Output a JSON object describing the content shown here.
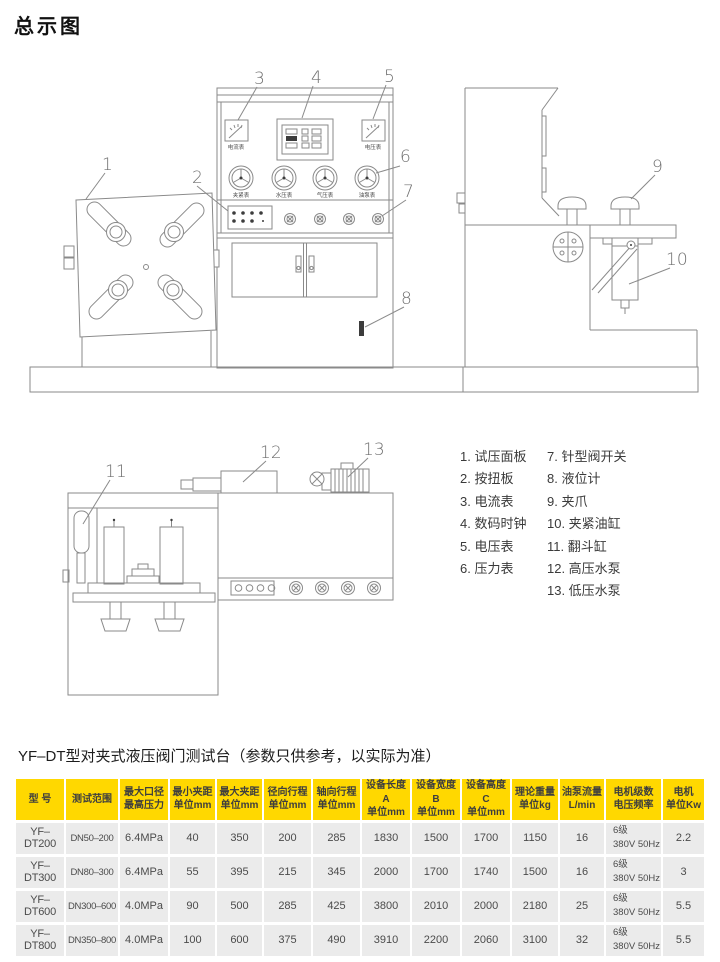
{
  "page": {
    "title": "总示图"
  },
  "diagram": {
    "callouts": [
      "1",
      "2",
      "3",
      "4",
      "5",
      "6",
      "7",
      "8",
      "9",
      "10",
      "11",
      "12",
      "13"
    ],
    "front": {
      "ammeter_label": "电流表",
      "voltmeter_label": "电压表",
      "gauges": [
        "夹紧表",
        "水压表",
        "气压表",
        "油泵表"
      ]
    }
  },
  "legend": {
    "items_left": [
      "1. 试压面板",
      "2. 按扭板",
      "3. 电流表",
      "4. 数码时钟",
      "5. 电压表",
      "6. 压力表"
    ],
    "items_right": [
      "7. 针型阀开关",
      "8. 液位计",
      "9. 夹爪",
      "10. 夹紧油缸",
      "11. 翻斗缸",
      "12. 高压水泵",
      "13. 低压水泵"
    ]
  },
  "spec": {
    "heading": "YF–DT型对夹式液压阀门测试台（参数只供参考，以实际为准）",
    "headers": [
      "型 号",
      "测试范围",
      "最大口径\n最高压力",
      "最小夹距\n单位mm",
      "最大夹距\n单位mm",
      "径向行程\n单位mm",
      "轴向行程\n单位mm",
      "设备长度A\n单位mm",
      "设备宽度B\n单位mm",
      "设备高度C\n单位mm",
      "理论重量\n单位kg",
      "油泵流量\nL/min",
      "电机级数\n电压频率",
      "电机\n单位Kw"
    ],
    "rows": [
      [
        "YF–DT200",
        "DN50–200",
        "6.4MPa",
        "40",
        "350",
        "200",
        "285",
        "1830",
        "1500",
        "1700",
        "1150",
        "16",
        "6级\n380V 50Hz",
        "2.2"
      ],
      [
        "YF–DT300",
        "DN80–300",
        "6.4MPa",
        "55",
        "395",
        "215",
        "345",
        "2000",
        "1700",
        "1740",
        "1500",
        "16",
        "6级\n380V 50Hz",
        "3"
      ],
      [
        "YF–DT600",
        "DN300–600",
        "4.0MPa",
        "90",
        "500",
        "285",
        "425",
        "3800",
        "2010",
        "2000",
        "2180",
        "25",
        "6级\n380V 50Hz",
        "5.5"
      ],
      [
        "YF–DT800",
        "DN350–800",
        "4.0MPa",
        "100",
        "600",
        "375",
        "490",
        "3910",
        "2200",
        "2060",
        "3100",
        "32",
        "6级\n380V 50Hz",
        "5.5"
      ]
    ]
  },
  "colors": {
    "table_header_bg": "#ffd800",
    "table_row_bg": "#ebebeb",
    "line": "#8a8a8a"
  }
}
